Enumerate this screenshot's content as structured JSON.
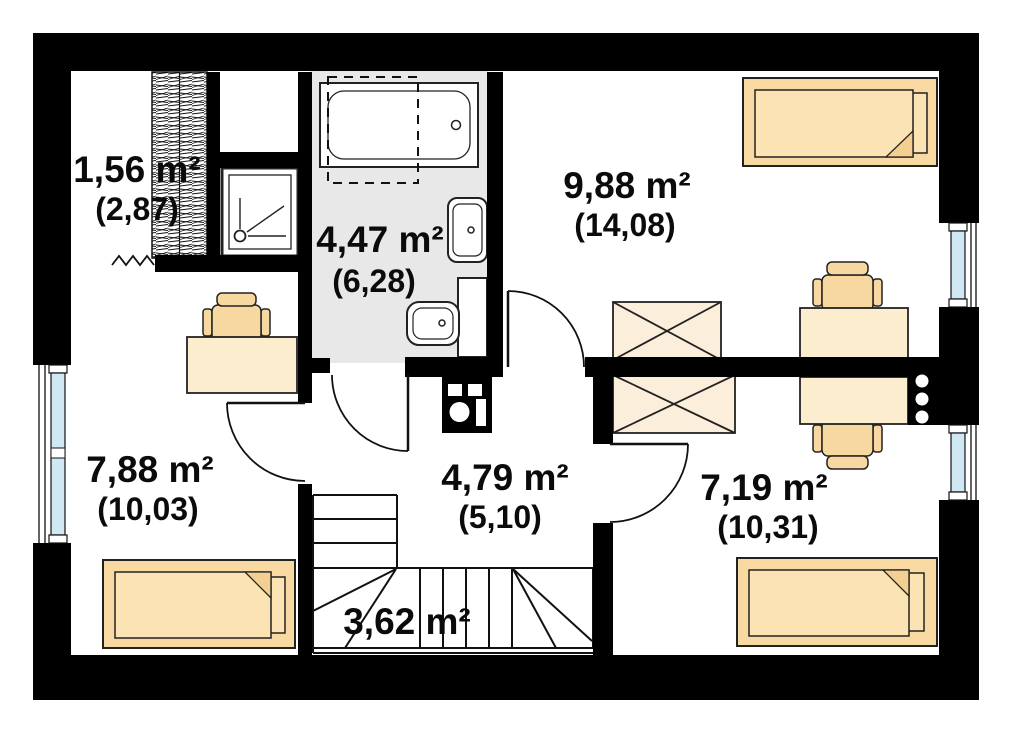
{
  "plan": {
    "type": "floor-plan",
    "rooms": [
      {
        "name": "closet",
        "area_label": "1,56 m²",
        "gross_label": "(2,87)"
      },
      {
        "name": "bathroom",
        "area_label": "4,47 m²",
        "gross_label": "(6,28)"
      },
      {
        "name": "bedroom-upper-right",
        "area_label": "9,88 m²",
        "gross_label": "(14,08)"
      },
      {
        "name": "bedroom-left",
        "area_label": "7,88 m²",
        "gross_label": "(10,03)"
      },
      {
        "name": "hall",
        "area_label": "4,79 m²",
        "gross_label": "(5,10)"
      },
      {
        "name": "bedroom-lower-right",
        "area_label": "7,19 m²",
        "gross_label": "(10,31)"
      },
      {
        "name": "staircase",
        "area_label": "3,62 m²",
        "gross_label": ""
      }
    ],
    "furniture": [
      "hatched-wardrobe",
      "shower",
      "bathtub",
      "washbasin",
      "toilet",
      "chimney-flue",
      "vent-stack",
      "bed",
      "duvet",
      "desk",
      "chair",
      "crossed-wardrobe",
      "stairs",
      "door",
      "window"
    ],
    "colors": {
      "wall": "#000000",
      "bathroom_floor": "#e8e8e8",
      "bed_frame": "#f8d9a2",
      "bed_duvet": "#fbe3b4",
      "bed_fold": "#f3cf92",
      "desk": "#fcedcf",
      "chair": "#f6d8a0",
      "wardrobe": "#fbeeda",
      "window_glass": "#cfe8f4",
      "line": "#111111"
    }
  }
}
